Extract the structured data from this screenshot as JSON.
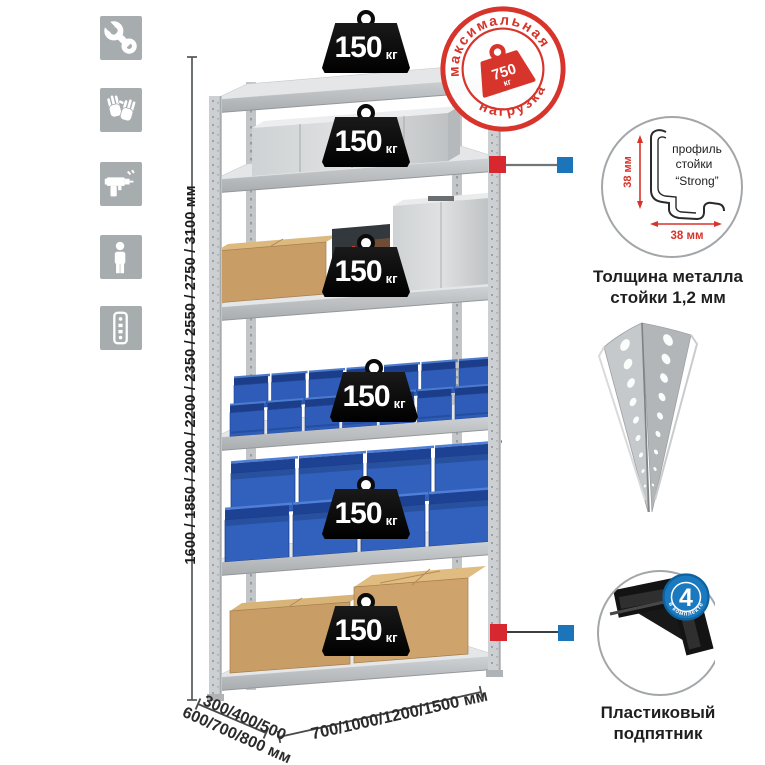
{
  "shelf_load": {
    "value": "150",
    "unit": "кг"
  },
  "max_load_stamp": {
    "arc_top": "максимальная",
    "arc_bottom": "нагрузка",
    "value": "750",
    "unit": "кг"
  },
  "dimensions": {
    "height": "1600 / 1850 / 2000 / 2200 / 2350 / 2550 / 2750 / 3100 мм",
    "depth_line1": "300/400/500",
    "depth_line2": "600/700/800 мм",
    "width": "700/1000/1200/1500 мм"
  },
  "post_profile": {
    "label_line1": "профиль",
    "label_line2": "стойки",
    "label_line3": "“Strong”",
    "dim_vertical": "38 мм",
    "dim_horizontal": "38 мм",
    "caption_line1": "Толщина металла",
    "caption_line2": "стойки 1,2 мм"
  },
  "plastic_foot": {
    "badge_value": "4",
    "badge_arc": "в комплекте",
    "caption_line1": "Пластиковый",
    "caption_line2": "подпятник"
  },
  "icons": [
    {
      "name": "wrench-icon"
    },
    {
      "name": "gloves-icon"
    },
    {
      "name": "drill-icon"
    },
    {
      "name": "person-icon"
    },
    {
      "name": "profile-strip-icon"
    }
  ],
  "colors": {
    "stamp_red": "#d7342c",
    "marker_red": "#d7282f",
    "marker_blue": "#1b75bb",
    "foot_badge_blue": "#1b79c0",
    "bin_blue": "#2e5cb8",
    "icon_gray": "#a7acaf",
    "metal_gray": "#c9cccf"
  }
}
